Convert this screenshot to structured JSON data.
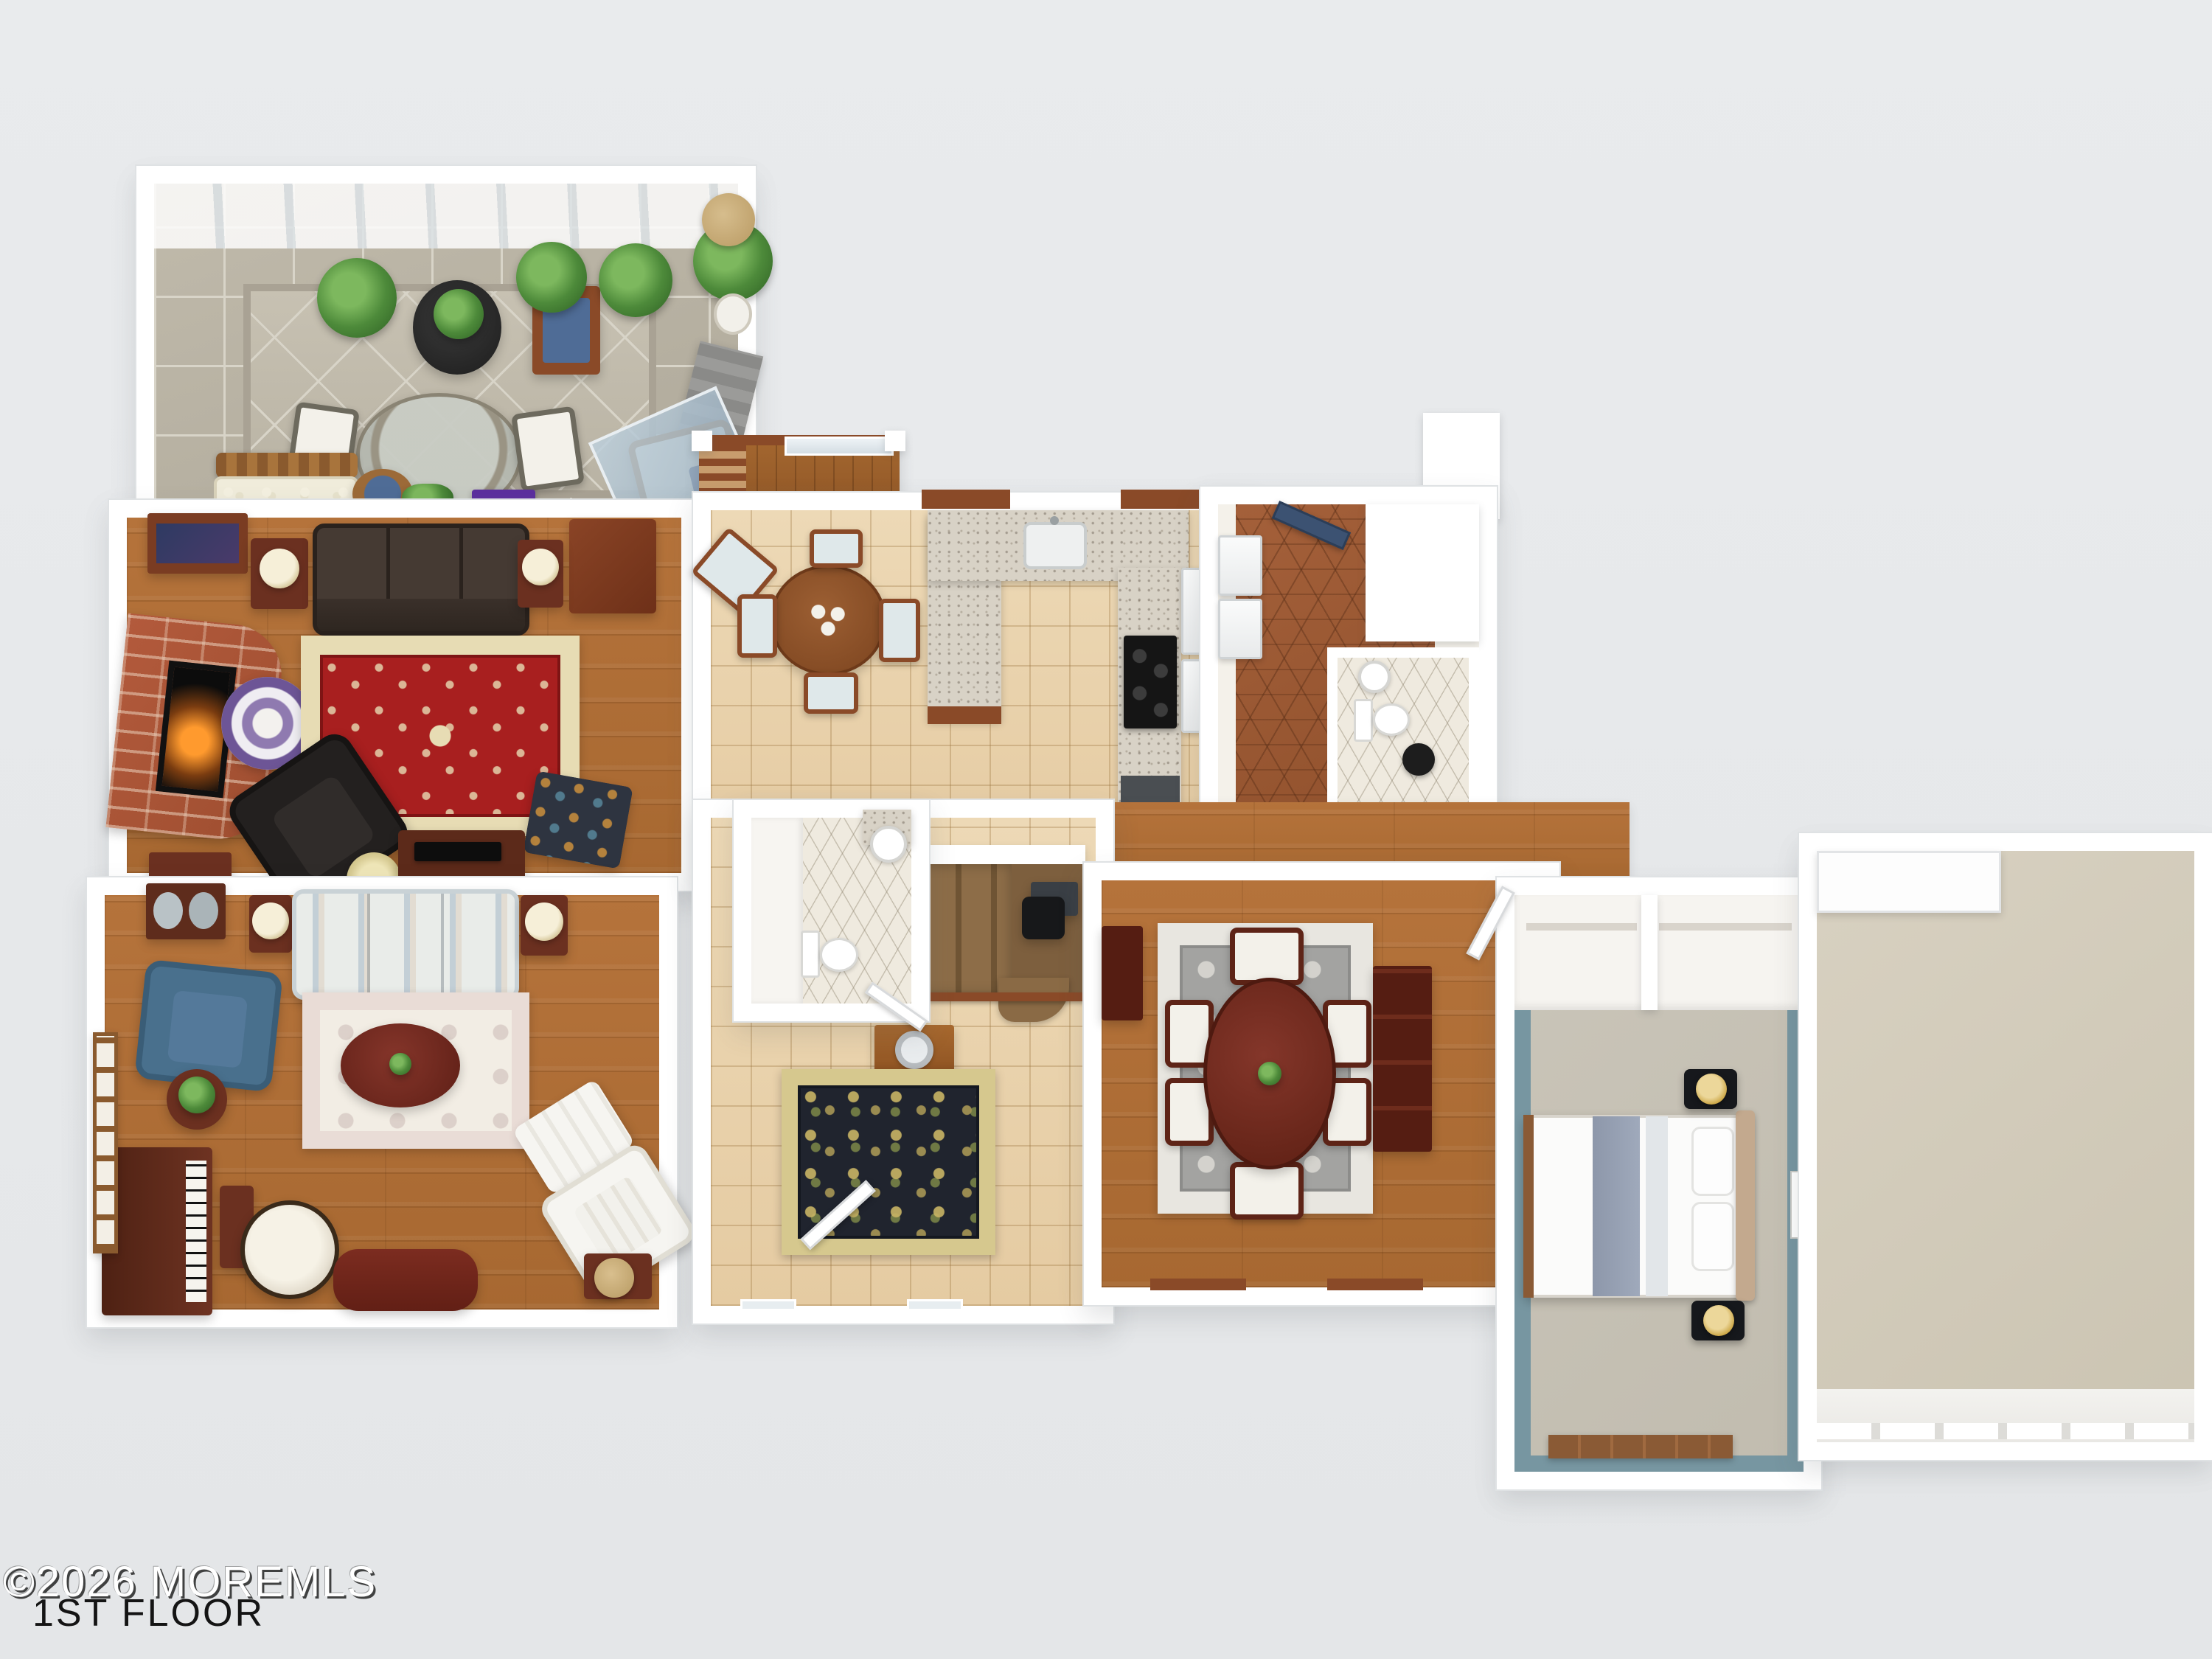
{
  "watermark": {
    "copyright": "©2026 MOREMLS",
    "floor_label": "1ST FLOOR"
  },
  "palette": {
    "background": "#e8eaec",
    "walls": "#ffffff",
    "hardwood": "#b0703a",
    "tile_beige": "#ead5ae",
    "stone_tile": "#bcb6a8",
    "terracotta_hex": "#9c5a33",
    "bathroom_hex": "#efeadf",
    "carpet": "#c8c3b7",
    "garage_concrete": "#d3ccbc",
    "stair_carpet": "#816143",
    "deck_wood": "#9c5f2e",
    "granite_counter": "#d8d2c6",
    "cabinet_wood": "#8a4a28",
    "brick_fireplace": "#b05a3c",
    "red_rug": "#a81f1f",
    "gray_rug": "#a3a3a1",
    "black_gold_rug": "#20242e",
    "cream_rug": "#f2ede4",
    "dark_leather_sofa": "#38302b",
    "striped_sofa": "#dde3e4",
    "blue_armchair": "#49708d",
    "piano_mahogany": "#5f2b1b",
    "dining_table": "#6e2a1f",
    "kitchen_table": "#8a512a",
    "teal_bedroom_wall": "#7796a1",
    "bed_runner": "#96a0b2",
    "headboard_tan": "#c3a98e",
    "accent_purple": "#5b2f9e",
    "door_navy": "#3c5272"
  }
}
